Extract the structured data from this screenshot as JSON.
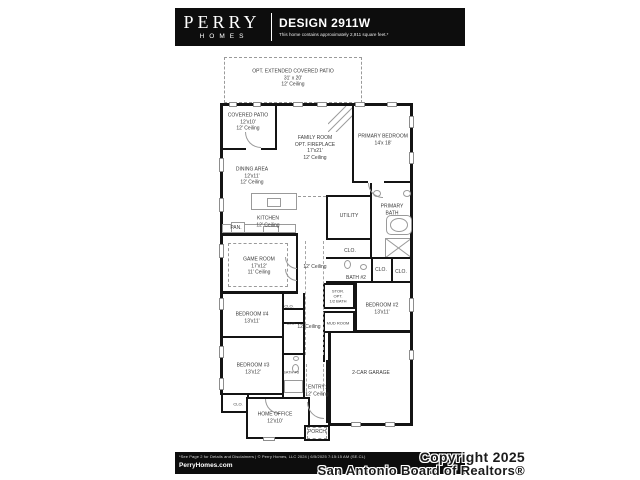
{
  "header": {
    "brand_line1": "PERRY",
    "brand_line2": "HOMES",
    "title": "DESIGN 2911W",
    "subtitle": "This home contains approximately 2,911 square feet.*"
  },
  "plan": {
    "opt_patio": {
      "name": "OPT. EXTENDED COVERED PATIO",
      "dims": "31' x 20'",
      "ceiling": "12' Ceiling"
    },
    "covered_patio": {
      "name": "COVERED PATIO",
      "dims": "12'x10'",
      "ceiling": "12' Ceiling"
    },
    "family_room": {
      "name": "FAMILY ROOM",
      "opt": "OPT. FIREPLACE",
      "dims": "17'x21'",
      "ceiling": "12' Ceiling"
    },
    "primary_bedroom": {
      "name": "PRIMARY BEDROOM",
      "dims": "14'x 18'"
    },
    "dining_area": {
      "name": "DINING AREA",
      "dims": "12'x11'",
      "ceiling": "12' Ceiling"
    },
    "kitchen": {
      "name": "KITCHEN",
      "ceiling": "12' Ceiling"
    },
    "pantry": {
      "name": "PAN."
    },
    "utility": {
      "name": "UTILITY"
    },
    "primary_bath": {
      "name": "PRIMARY BATH"
    },
    "game_room": {
      "name": "GAME ROOM",
      "dims": "17'x12'",
      "ceiling": "11' Ceiling"
    },
    "bath_2": {
      "name": "BATH #2"
    },
    "storage": {
      "name": "STOR.",
      "opt1": "OPT.",
      "opt2": "1/2 BATH"
    },
    "bedroom_2": {
      "name": "BEDROOM #2",
      "dims": "13'x11'"
    },
    "mud_room": {
      "name": "MUD ROOM"
    },
    "bedroom_4": {
      "name": "BEDROOM #4",
      "dims": "13'x11'"
    },
    "bedroom_3": {
      "name": "BEDROOM #3",
      "dims": "13'x12'"
    },
    "bath_3": {
      "name": "BATH #3"
    },
    "entry": {
      "name": "ENTRY:",
      "ceiling": "12' Ceiling"
    },
    "garage": {
      "name": "2-CAR GARAGE"
    },
    "home_office": {
      "name": "HOME OFFICE",
      "dims": "12'x10'"
    },
    "porch": {
      "name": "PORCH"
    },
    "ceilings": {
      "hall_upper": "12' Ceiling",
      "hall_lower": "12' Ceiling"
    },
    "closets": {
      "utility": "CLO.",
      "b2_left": "CLO.",
      "b2_right": "CLO.",
      "b4_upper": "CLO.",
      "b4_lower": "CLO.",
      "office": "CLO."
    }
  },
  "footer": {
    "disclaimer": "*See Page 2 for Details and Disclaimers | © Perry Homes, LLC 2024 | 6/5/2025 7:15:15 AM (SE.CL)",
    "website": "PerryHomes.com"
  },
  "copyright": {
    "line1": "Copyright 2025",
    "line2": "San Antonio Board of Realtors®"
  },
  "colors": {
    "bar_bg": "#0d0d0d",
    "wall": "#141414",
    "label": "#3a3a3a"
  }
}
